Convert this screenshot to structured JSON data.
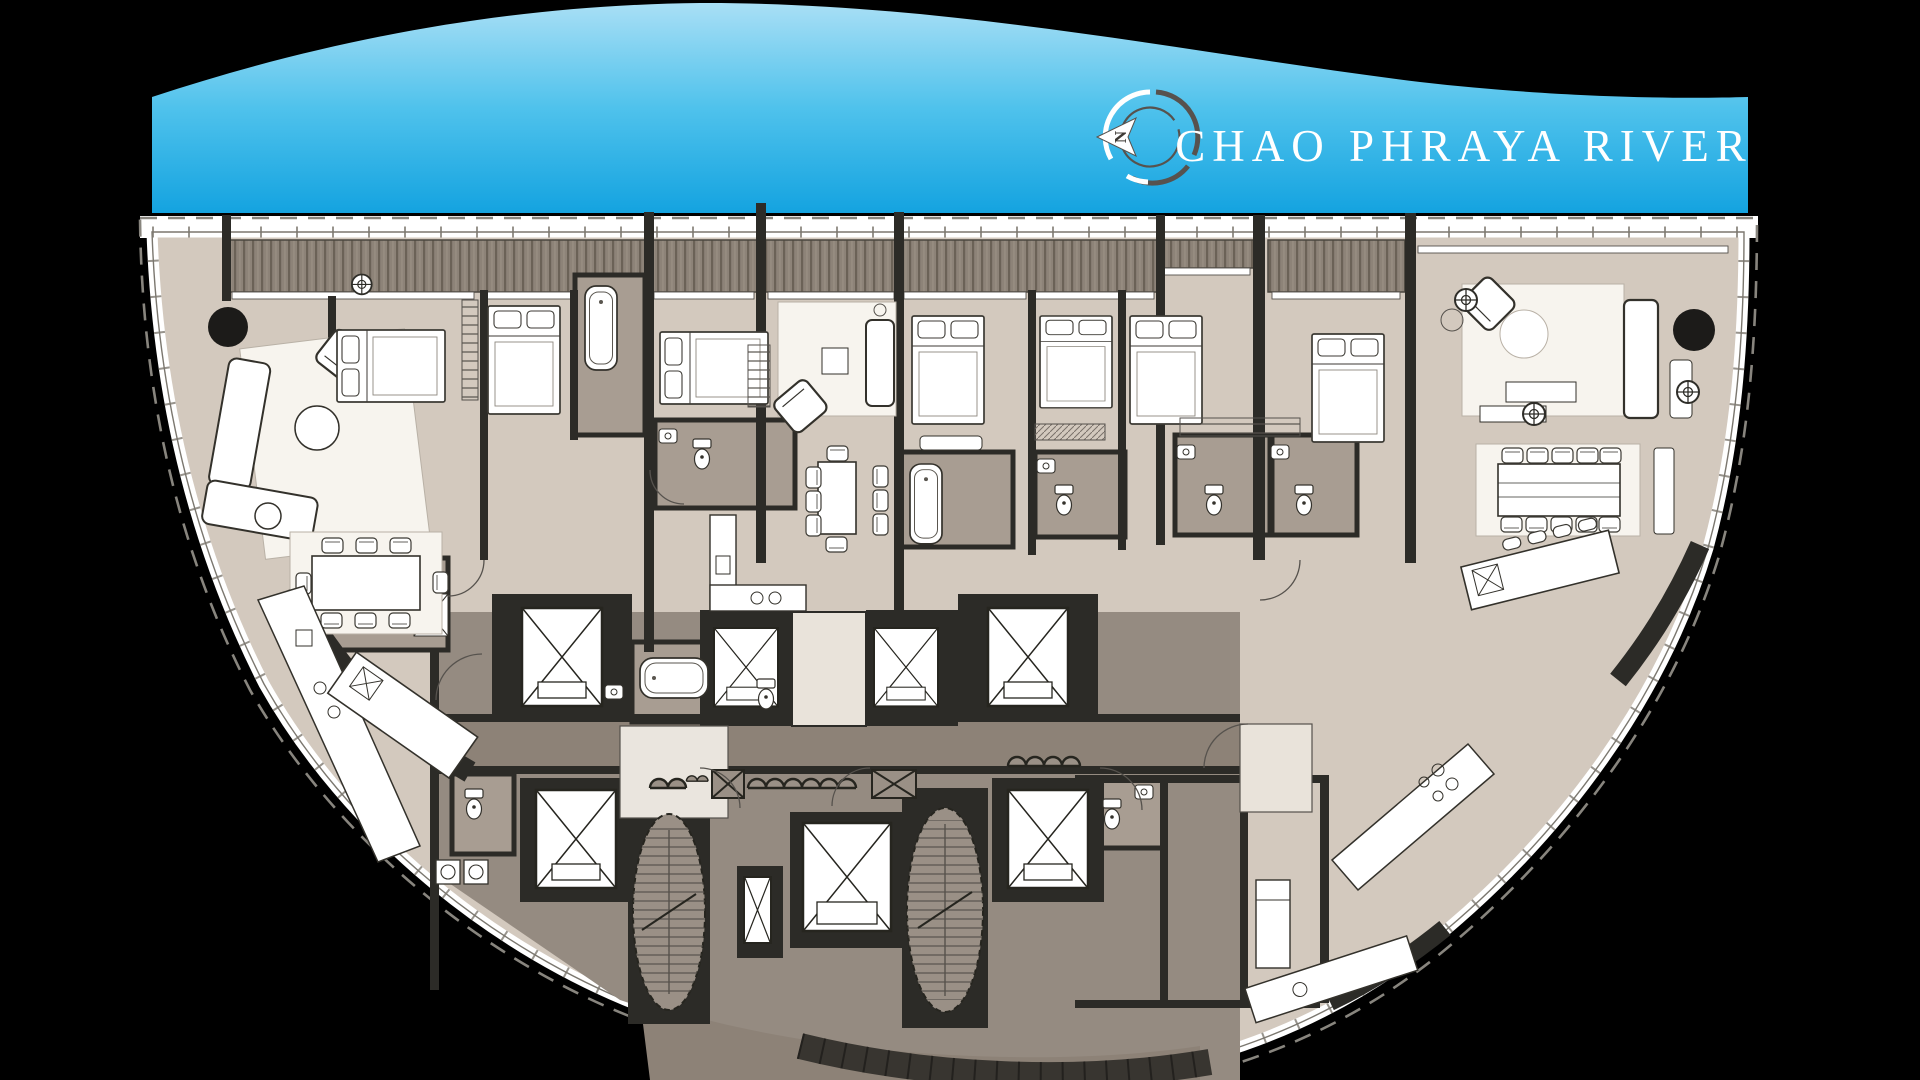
{
  "banner": {
    "river_label": "CHAO PHRAYA RIVER",
    "compass_letter": "N",
    "gradient_top": "#a9dff5",
    "gradient_mid": "#4fc2ec",
    "gradient_bottom": "#14a3e0",
    "text_color": "#ffffff"
  },
  "plan": {
    "background": "#000000",
    "palette": {
      "wall": "#2c2b27",
      "unit_floor": "#d3c9be",
      "core_floor": "#958b81",
      "corridor_floor": "#8d8277",
      "bathroom_floor": "#a89d92",
      "deck": "#8d8378",
      "deck_stripe": "#6b6257",
      "rug": "#f7f4ee",
      "furniture": "#ffffff",
      "lobby_floor": "#e9e3da",
      "boundary_dash": "#88857e",
      "glass": "#ffffff"
    }
  }
}
